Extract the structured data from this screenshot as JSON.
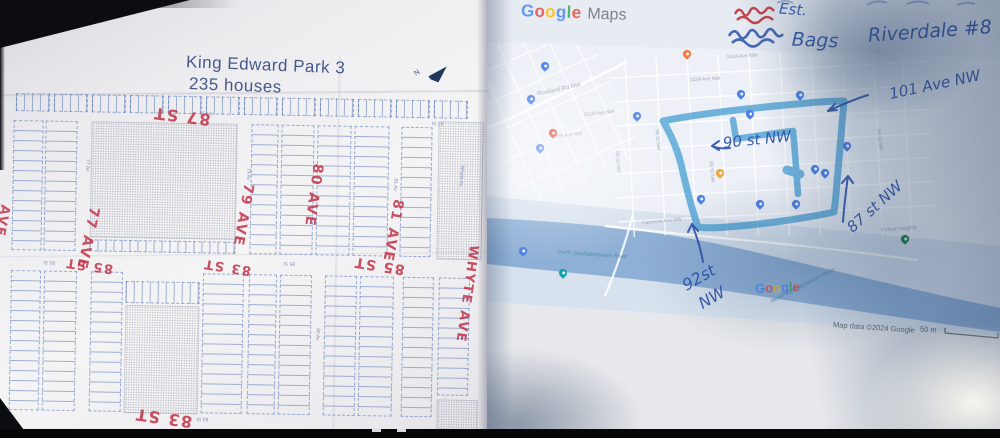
{
  "colors": {
    "red-ink": "#c23349",
    "blue-pen": "#2b51a8",
    "route": "#3d9ad2",
    "water": "#8fb0d6",
    "google-blue": "#4285F4",
    "google-red": "#EA4335",
    "google-yellow": "#FBBC05",
    "google-green": "#34A853"
  },
  "left_map": {
    "title_line1": "King Edward Park 3",
    "title_line2": "235 houses",
    "north_label": "N",
    "red_annotations": [
      {
        "text": "87 ST",
        "x": 180,
        "y": 117,
        "rot": 186,
        "size": 16
      },
      {
        "text": "79 AVE",
        "x": 243,
        "y": 215,
        "rot": 99,
        "size": 14
      },
      {
        "text": "80 AVE",
        "x": 313,
        "y": 194,
        "rot": 97,
        "size": 14
      },
      {
        "text": "81 AVE",
        "x": 393,
        "y": 228,
        "rot": 99,
        "size": 14
      },
      {
        "text": "77 AVE",
        "x": 88,
        "y": 241,
        "rot": 101,
        "size": 14
      },
      {
        "text": "85 ST",
        "x": 90,
        "y": 268,
        "rot": 187,
        "size": 13
      },
      {
        "text": "83 ST",
        "x": 228,
        "y": 267,
        "rot": 188,
        "size": 13
      },
      {
        "text": "85 ST",
        "x": 380,
        "y": 263,
        "rot": 188,
        "size": 14
      },
      {
        "text": "83 ST",
        "x": 167,
        "y": 419,
        "rot": 187,
        "size": 16
      },
      {
        "text": "WHYTE AVE",
        "x": 468,
        "y": 290,
        "rot": 97,
        "size": 13
      },
      {
        "text": "AVE",
        "x": 2,
        "y": 225,
        "rot": 100,
        "size": 13
      }
    ],
    "printed_labels": [
      {
        "text": "87 St",
        "x": 204,
        "y": 113,
        "rot": 180,
        "size": 5
      },
      {
        "text": "87 St",
        "x": 436,
        "y": 119,
        "rot": 180,
        "size": 5
      },
      {
        "text": "79 Av",
        "x": 247,
        "y": 174,
        "rot": 92,
        "size": 5
      },
      {
        "text": "77 Av",
        "x": 86,
        "y": 168,
        "rot": 92,
        "size": 5
      },
      {
        "text": "81 Av",
        "x": 394,
        "y": 182,
        "rot": 92,
        "size": 5
      },
      {
        "text": "85 St",
        "x": 50,
        "y": 265,
        "rot": 180,
        "size": 5
      },
      {
        "text": "85 St",
        "x": 290,
        "y": 262,
        "rot": 180,
        "size": 5
      },
      {
        "text": "83 St",
        "x": 206,
        "y": 419,
        "rot": 180,
        "size": 5
      },
      {
        "text": "Whyte Av",
        "x": 460,
        "y": 172,
        "rot": 93,
        "size": 5
      },
      {
        "text": "80 Av",
        "x": 319,
        "y": 333,
        "rot": 92,
        "size": 5
      }
    ]
  },
  "right_map": {
    "logo_letters": [
      {
        "ch": "G",
        "color": "#4285F4"
      },
      {
        "ch": "o",
        "color": "#EA4335"
      },
      {
        "ch": "o",
        "color": "#FBBC05"
      },
      {
        "ch": "g",
        "color": "#4285F4"
      },
      {
        "ch": "l",
        "color": "#34A853"
      },
      {
        "ch": "e",
        "color": "#EA4335"
      }
    ],
    "logo_maps": "Maps",
    "attribution": "Map data ©2024 Google",
    "scale": "50 m",
    "handwriting": [
      {
        "text": "Est.",
        "x": 306,
        "y": 10,
        "rot": 4,
        "size": 15
      },
      {
        "text": "Bags",
        "x": 328,
        "y": 41,
        "rot": 2,
        "size": 19
      },
      {
        "text": "Riverdale #8",
        "x": 443,
        "y": 32,
        "rot": -4,
        "size": 19
      },
      {
        "text": "101 Ave NW",
        "x": 448,
        "y": 85,
        "rot": -12,
        "size": 15
      },
      {
        "text": "90 st NW",
        "x": 270,
        "y": 140,
        "rot": -6,
        "size": 15
      },
      {
        "text": "87 st NW",
        "x": 388,
        "y": 207,
        "rot": -42,
        "size": 15
      },
      {
        "text": "92st",
        "x": 212,
        "y": 278,
        "rot": -30,
        "size": 16
      },
      {
        "text": "NW",
        "x": 225,
        "y": 298,
        "rot": -30,
        "size": 16
      }
    ],
    "map_labels": [
      {
        "text": "Rowland Rd NW",
        "x": 72,
        "y": 90,
        "rot": -12,
        "size": 6
      },
      {
        "text": "101A Ave NW",
        "x": 112,
        "y": 114,
        "rot": -6,
        "size": 5
      },
      {
        "text": "100A Ave NW",
        "x": 80,
        "y": 136,
        "rot": -6,
        "size": 5
      },
      {
        "text": "103A Ave NW",
        "x": 255,
        "y": 57,
        "rot": -3,
        "size": 5
      },
      {
        "text": "102A Ave NW",
        "x": 218,
        "y": 80,
        "rot": -3,
        "size": 5
      },
      {
        "text": "Cameron Ave NW",
        "x": 175,
        "y": 222,
        "rot": -5,
        "size": 5
      },
      {
        "text": "98 St NW",
        "x": 170,
        "y": 140,
        "rot": 85,
        "size": 5
      },
      {
        "text": "95 St NW",
        "x": 130,
        "y": 162,
        "rot": 85,
        "size": 5
      },
      {
        "text": "92 St NW",
        "x": 224,
        "y": 172,
        "rot": 85,
        "size": 5
      },
      {
        "text": "84 St NW",
        "x": 392,
        "y": 140,
        "rot": 83,
        "size": 5
      },
      {
        "text": "Forest Heights",
        "x": 412,
        "y": 230,
        "rot": -4,
        "size": 5.5
      },
      {
        "text": "North Saskatchewan River",
        "x": 105,
        "y": 255,
        "rot": 4,
        "size": 6,
        "italic": true,
        "color": "#43889e"
      },
      {
        "text": "North Saskatchewan River",
        "x": 316,
        "y": 286,
        "rot": -27,
        "size": 6,
        "italic": true,
        "color": "#43889e"
      }
    ]
  }
}
